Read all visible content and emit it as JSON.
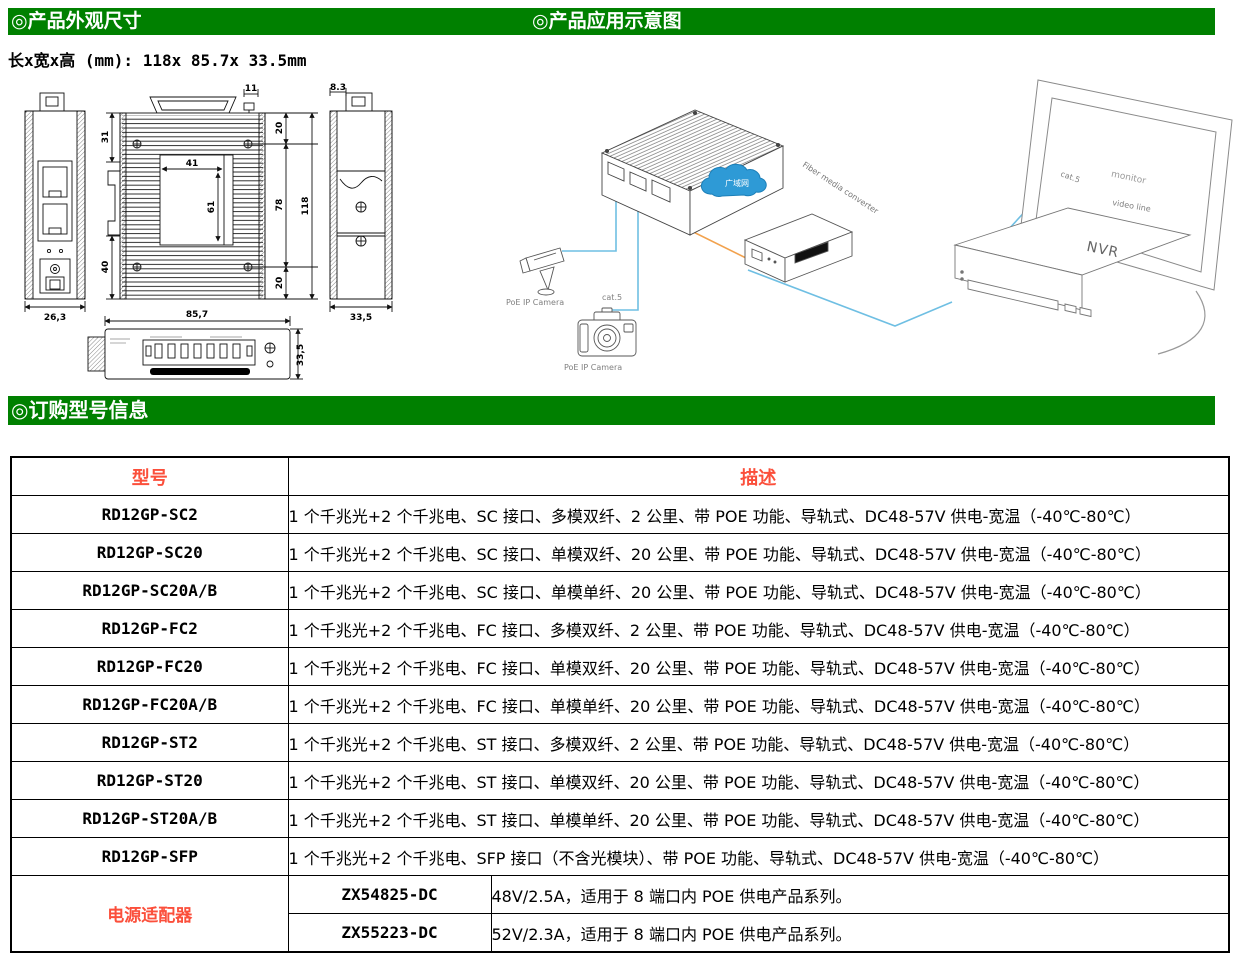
{
  "sections": {
    "appearance_title": "◎产品外观尺寸",
    "application_title": "◎产品应用示意图",
    "ordering_title": "◎订购型号信息"
  },
  "appearance": {
    "size_line": "长x宽x高 (mm): 118x 85.7x 33.5mm",
    "dims": {
      "tab_w": "11",
      "top_inset": "20",
      "upper_left": "31",
      "plate_w": "41",
      "plate_h": "61",
      "body_mid": "78",
      "total_h": "118",
      "lower_left": "40",
      "bottom_inset": "20",
      "front_w": "26,3",
      "side_tab": "8.3",
      "side_depth": "33,5",
      "bottom_w": "85,7",
      "bottom_d": "33,5"
    }
  },
  "application": {
    "cloud_label": "广域网",
    "converter_label": "Fiber media converter",
    "monitor_label": "monitor",
    "nvr_label": "NVR",
    "cat5_label_a": "cat.5",
    "cat5_label_b": "cat.5",
    "video_line_label": "video line",
    "camera_a_label": "PoE IP Camera",
    "camera_b_label": "PoE IP Camera"
  },
  "table": {
    "col_model": "型号",
    "col_desc": "描述",
    "rows": [
      {
        "model": "RD12GP-SC2",
        "desc": "1 个千兆光+2 个千兆电、SC 接口、多模双纤、2 公里、带 POE 功能、导轨式、DC48-57V 供电-宽温（-40℃-80℃）"
      },
      {
        "model": "RD12GP-SC20",
        "desc": "1 个千兆光+2 个千兆电、SC 接口、单模双纤、20 公里、带 POE 功能、导轨式、DC48-57V 供电-宽温（-40℃-80℃）"
      },
      {
        "model": "RD12GP-SC20A/B",
        "desc": "1 个千兆光+2 个千兆电、SC 接口、单模单纤、20 公里、带 POE 功能、导轨式、DC48-57V 供电-宽温（-40℃-80℃）"
      },
      {
        "model": "RD12GP-FC2",
        "desc": "1 个千兆光+2 个千兆电、FC 接口、多模双纤、2 公里、带 POE 功能、导轨式、DC48-57V 供电-宽温（-40℃-80℃）"
      },
      {
        "model": "RD12GP-FC20",
        "desc": "1 个千兆光+2 个千兆电、FC 接口、单模双纤、20 公里、带 POE 功能、导轨式、DC48-57V 供电-宽温（-40℃-80℃）"
      },
      {
        "model": "RD12GP-FC20A/B",
        "desc": "1 个千兆光+2 个千兆电、FC 接口、单模单纤、20 公里、带 POE 功能、导轨式、DC48-57V 供电-宽温（-40℃-80℃）"
      },
      {
        "model": "RD12GP-ST2",
        "desc": "1 个千兆光+2 个千兆电、ST 接口、多模双纤、2 公里、带 POE 功能、导轨式、DC48-57V 供电-宽温（-40℃-80℃）"
      },
      {
        "model": "RD12GP-ST20",
        "desc": "1 个千兆光+2 个千兆电、ST 接口、单模双纤、20 公里、带 POE 功能、导轨式、DC48-57V 供电-宽温（-40℃-80℃）"
      },
      {
        "model": "RD12GP-ST20A/B",
        "desc": "1 个千兆光+2 个千兆电、ST 接口、单模单纤、20 公里、带 POE 功能、导轨式、DC48-57V 供电-宽温（-40℃-80℃）"
      },
      {
        "model": "RD12GP-SFP",
        "desc": "1 个千兆光+2 个千兆电、SFP 接口（不含光模块）、带 POE 功能、导轨式、DC48-57V 供电-宽温（-40℃-80℃）"
      }
    ],
    "adapter": {
      "label": "电源适配器",
      "rows": [
        {
          "model": "ZX54825-DC",
          "desc": "48V/2.5A，适用于 8 端口内 POE 供电产品系列。"
        },
        {
          "model": "ZX55223-DC",
          "desc": "52V/2.3A，适用于 8 端口内 POE 供电产品系列。"
        }
      ]
    }
  },
  "colors": {
    "header_green": "#008000",
    "accent_red": "#fb4f3b",
    "cable_blue": "#6fbfe3",
    "cable_orange": "#f2a24e",
    "cloud_blue": "#2e9ad6"
  }
}
